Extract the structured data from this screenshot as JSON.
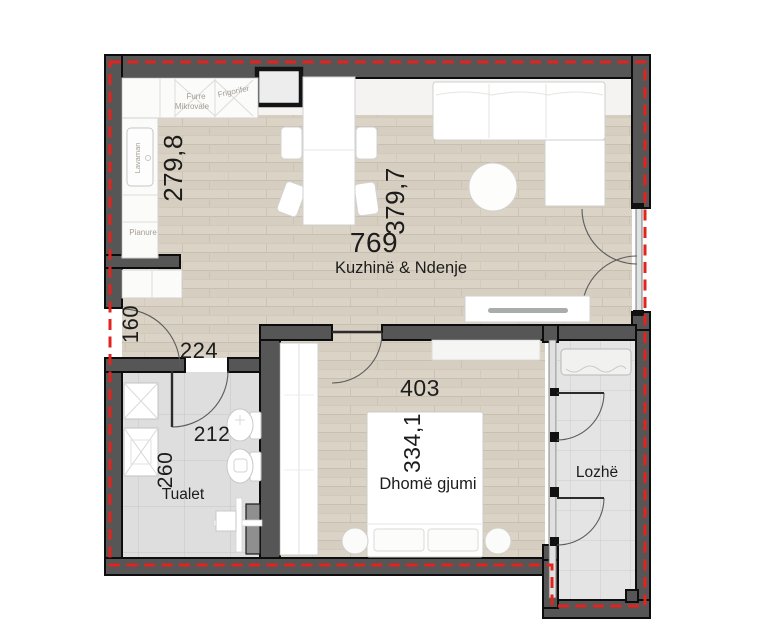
{
  "rooms": {
    "living": {
      "name": "Kuzhinë & Ndenje",
      "area": "769",
      "dim_left": "279,8",
      "dim_right": "379,7"
    },
    "hall": {
      "dim_vertical": "160",
      "dim_horizontal": "224"
    },
    "bathroom": {
      "name": "Tualet",
      "dim_width": "212",
      "dim_height": "260"
    },
    "bedroom": {
      "name": "Dhomë gjumi",
      "dim_width": "403",
      "dim_height": "334,1"
    },
    "loggia": {
      "name": "Lozhë"
    }
  },
  "kitchen_labels": {
    "oven_line1": "Furre",
    "oven_line2": "Mikrovale",
    "fridge": "Frigorifer",
    "sink": "Lavaman",
    "hob": "Pianure"
  },
  "colors": {
    "boundary_dashed": "#e3231d",
    "wall": "#565656",
    "wall_outline": "#0d0d0d",
    "wood_floor": "#dad3c6",
    "bath_floor": "#dedede",
    "loggia_floor": "#e4e4e4",
    "furniture": "#ffffff"
  }
}
